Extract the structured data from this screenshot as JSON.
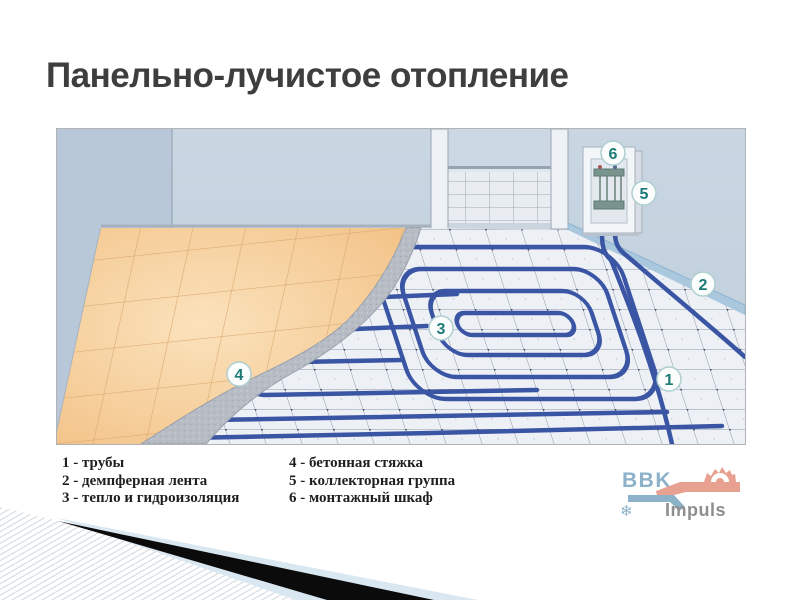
{
  "slide": {
    "title": "Панельно-лучистое отопление"
  },
  "diagram": {
    "description": "cutaway of underfloor radiant heating installation",
    "callouts": [
      {
        "number": "1"
      },
      {
        "number": "2"
      },
      {
        "number": "3"
      },
      {
        "number": "4"
      },
      {
        "number": "5"
      },
      {
        "number": "6"
      }
    ]
  },
  "legend": {
    "items": [
      "1 - трубы",
      "2 - демпферная лента",
      "3 - тепло и гидроизоляция",
      "4 - бетонная стяжка",
      "5 - коллекторная группа",
      "6 - монтажный шкаф"
    ]
  },
  "logo": {
    "brand": "BBK",
    "product": "Impuls",
    "snowflake_icon": "❄"
  },
  "colors": {
    "pipe": "#3a55a4",
    "wall": "#c5d3e0",
    "finished_tile": "#f5cb95",
    "screed": "#b7bcc5",
    "callout_text": "#1c7b76",
    "logo_blue": "#8cb2ca",
    "logo_salmon": "#e8a091"
  }
}
